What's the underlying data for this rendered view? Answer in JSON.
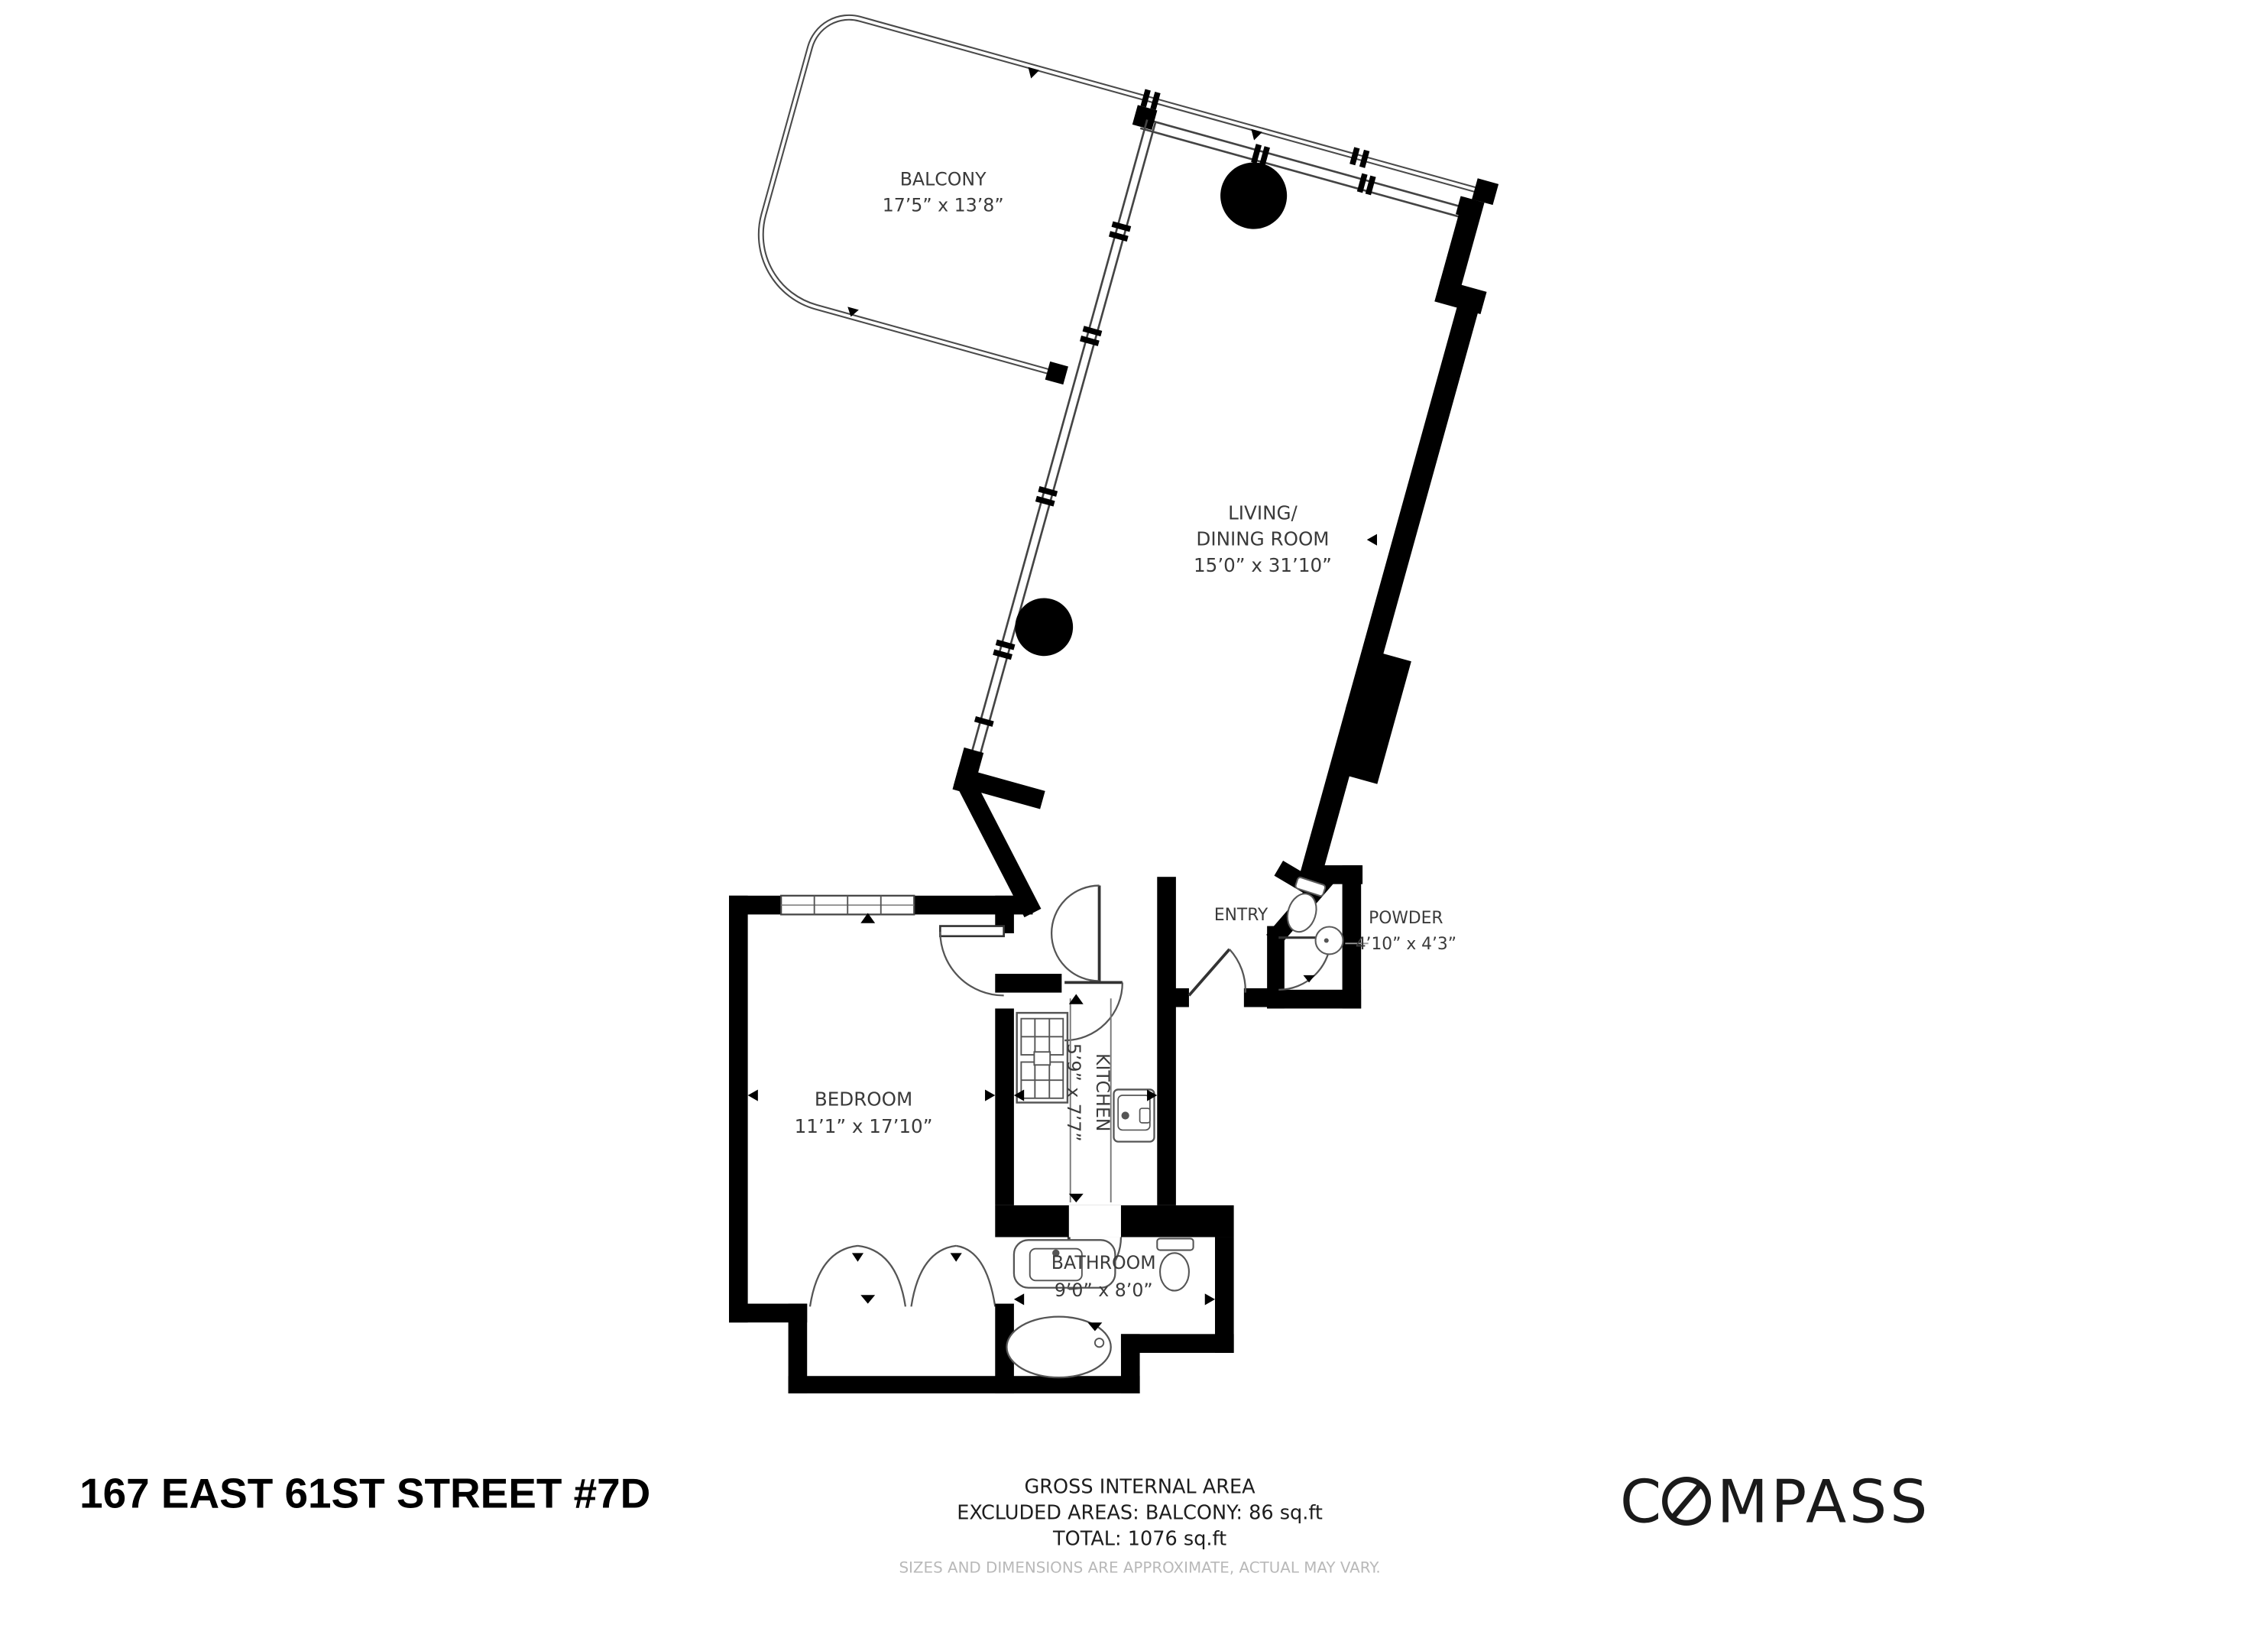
{
  "title": "167 EAST 61ST STREET #7D",
  "logo": {
    "full": "COMPASS",
    "part1": "C",
    "part2": "MPASS"
  },
  "footer": {
    "line1": "GROSS INTERNAL AREA",
    "line2": "EXCLUDED AREAS: BALCONY: 86 sq.ft",
    "line3": "TOTAL: 1076 sq.ft",
    "disclaimer": "SIZES AND DIMENSIONS ARE APPROXIMATE, ACTUAL MAY VARY."
  },
  "rooms": {
    "balcony": {
      "name": "BALCONY",
      "dims": "17’5” x 13’8”"
    },
    "living": {
      "name_line1": "LIVING/",
      "name_line2": "DINING ROOM",
      "dims": "15’0” x 31’10”"
    },
    "entry": {
      "name": "ENTRY"
    },
    "powder": {
      "name": "POWDER",
      "dims": "4’10” x 4’3”"
    },
    "kitchen": {
      "name": "KITCHEN",
      "dims": "5’9” x 7’7”"
    },
    "bedroom": {
      "name": "BEDROOM",
      "dims": "11’1” x 17’10”"
    },
    "bathroom": {
      "name": "BATHROOM",
      "dims": "9’0” x 8’0”"
    }
  },
  "colors": {
    "wall": "#000000",
    "thin_line": "#4a4a4a",
    "label": "#3a3a3a",
    "muted": "#b9b9b9"
  }
}
